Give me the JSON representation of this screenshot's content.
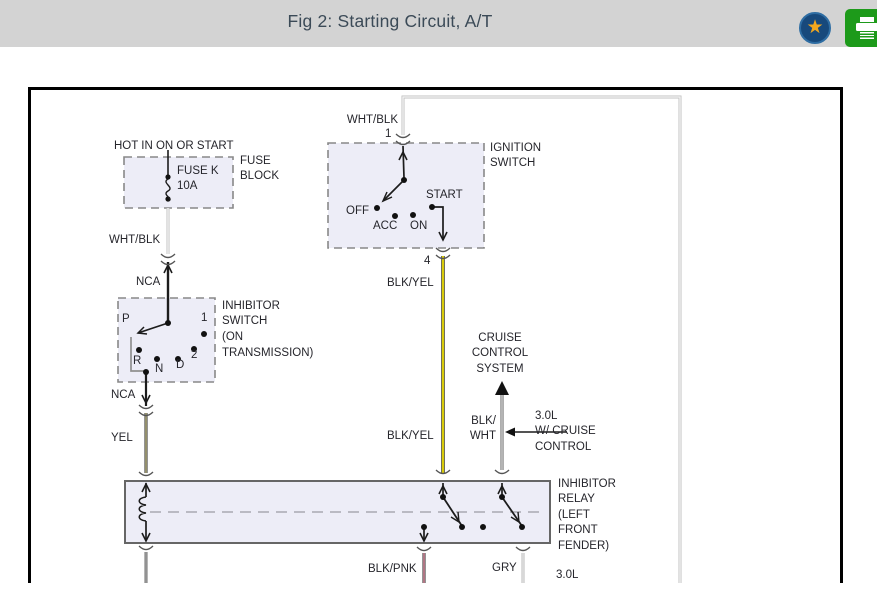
{
  "header": {
    "title": "Fig 2: Starting Circuit, A/T",
    "favorite_icon": "star",
    "print_icon": "printer",
    "colors": {
      "bar_bg": "#d3d3d3",
      "badge_navy": "#17497c",
      "star_orange": "#f2a71e",
      "print_green": "#1d9a1a"
    }
  },
  "figure": {
    "colors": {
      "box_fill": "#ededf7",
      "wire_yellow": "#f2e204",
      "wire_pink": "#f8a0b4",
      "wire_gray": "#c2c2c2",
      "text": "#26262c"
    },
    "fuse": {
      "hot": "HOT IN ON OR START",
      "name": "FUSE K",
      "rating": "10A",
      "block1": "FUSE",
      "block2": "BLOCK",
      "wire_out": "WHT/BLK",
      "nca": "NCA"
    },
    "ignition": {
      "wire_in": "WHT/BLK",
      "pin_in": "1",
      "label1": "IGNITION",
      "label2": "SWITCH",
      "off": "OFF",
      "acc": "ACC",
      "on": "ON",
      "start": "START",
      "pin_out": "4",
      "wire_out1": "BLK/YEL",
      "wire_out2": "BLK/YEL"
    },
    "inhibitor_switch": {
      "label1": "INHIBITOR",
      "label2": "SWITCH",
      "label3": "(ON",
      "label4": "TRANSMISSION)",
      "pos_p": "P",
      "pos_1": "1",
      "pos_r": "R",
      "pos_n": "N",
      "pos_d": "D",
      "pos_2": "2",
      "nca": "NCA",
      "wire_out": "YEL"
    },
    "cruise": {
      "line1": "CRUISE",
      "line2": "CONTROL",
      "line3": "SYSTEM",
      "wire1": "BLK/",
      "wire2": "WHT",
      "note1": "3.0L",
      "note2": "W/ CRUISE",
      "note3": "CONTROL"
    },
    "relay": {
      "label1": "INHIBITOR",
      "label2": "RELAY",
      "label3": "(LEFT",
      "label4": "FRONT",
      "label5": "FENDER)",
      "out1": "BLK/PNK",
      "out2": "GRY",
      "note": "3.0L"
    }
  }
}
